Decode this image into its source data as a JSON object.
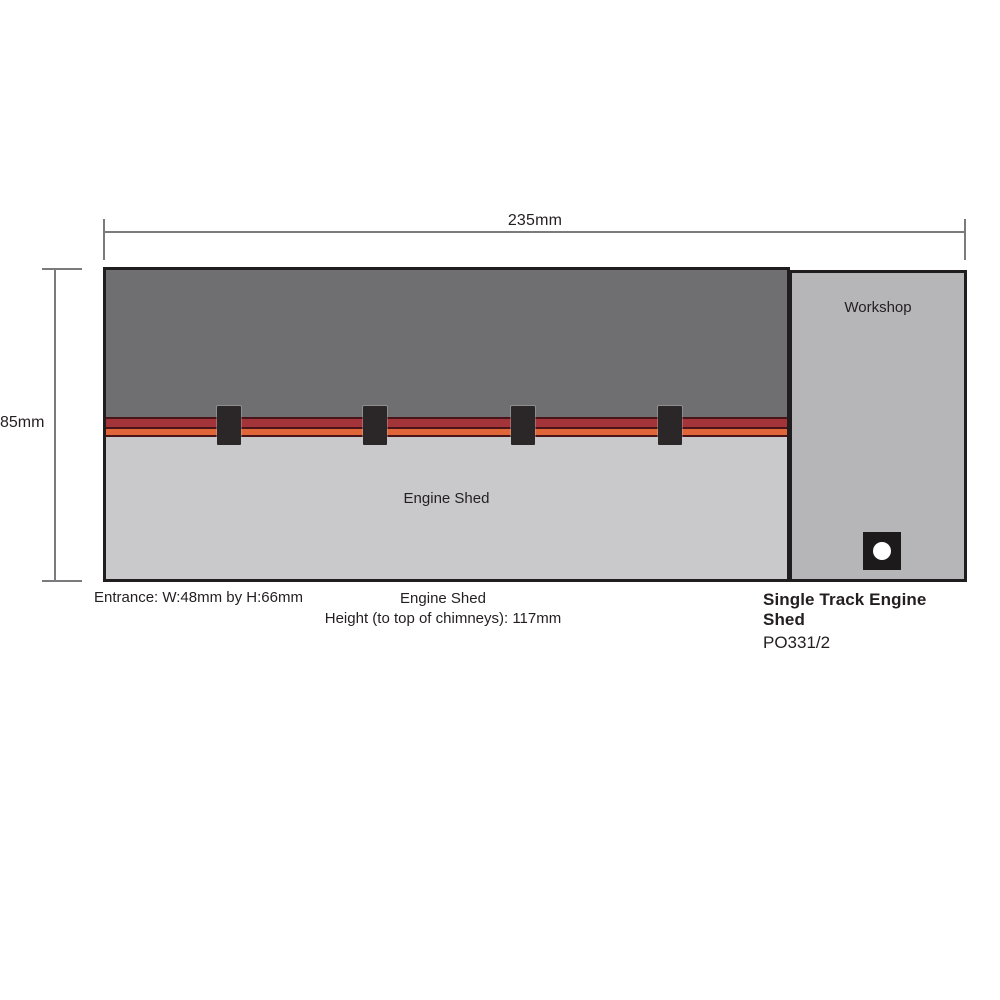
{
  "diagram": {
    "dimensions": {
      "width_label": "235mm",
      "height_label": "85mm"
    },
    "building": {
      "engine_shed_label": "Engine Shed",
      "workshop_label": "Workshop",
      "tabs_count": 4
    },
    "captions": {
      "entrance": "Entrance: W:48mm by H:66mm",
      "shed_title": "Engine Shed",
      "shed_height": "Height (to top of chimneys): 117mm"
    },
    "product": {
      "title": "Single Track Engine Shed",
      "code": "PO331/2"
    },
    "colors": {
      "roof_gray": "#6f6f71",
      "wall_gray": "#c9c9cb",
      "workshop_gray": "#b6b6b8",
      "stripe_red": "#a3343a",
      "stripe_orange": "#e0663a",
      "stripe_edge": "#4a1518",
      "tab_black": "#2b2728",
      "outline_black": "#201d1e",
      "dimension_gray": "#7b7b7d",
      "text_black": "#231f20"
    }
  }
}
